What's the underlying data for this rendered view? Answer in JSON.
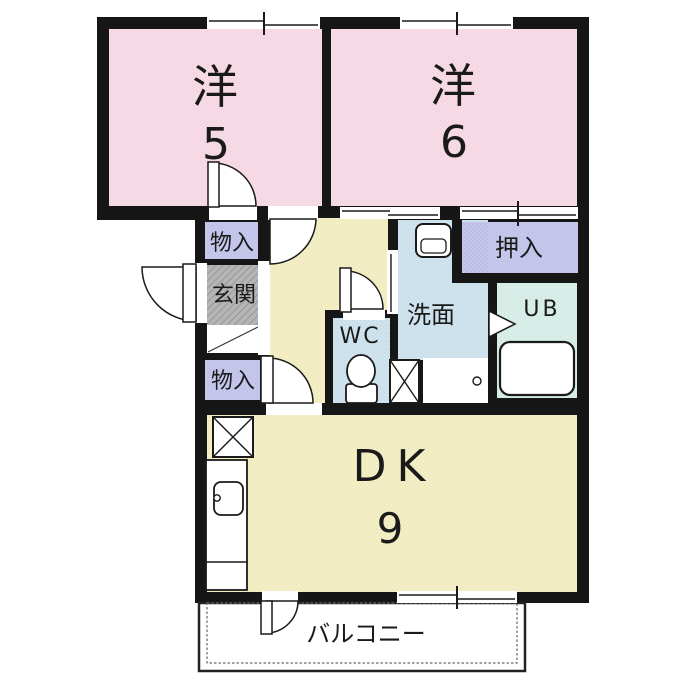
{
  "plan": {
    "type": "floor-plan",
    "layout_name": "2DK"
  },
  "colors": {
    "wall": "#161616",
    "room_pink": "#f8dbe7",
    "hall_cream": "#f5efc5",
    "closet_lavender": "#c6c7ec",
    "entry_gray": "#b5b5b5",
    "wet_blue": "#cfe4ee",
    "bath_mint": "#d9efe9",
    "fixture_white": "#ffffff",
    "balcony_line": "#333333"
  },
  "rooms": {
    "bedroom_west_5": {
      "name": "洋",
      "size": "5"
    },
    "bedroom_west_6": {
      "name": "洋",
      "size": "6"
    },
    "closet_top": {
      "name": "物入"
    },
    "entrance": {
      "name": "玄関"
    },
    "closet_mid": {
      "name": "物入"
    },
    "toilet": {
      "name": "WC"
    },
    "washroom": {
      "name": "洗面"
    },
    "oshiire_closet": {
      "name": "押入"
    },
    "unit_bath": {
      "name": "UB"
    },
    "dining_kitchen": {
      "name": "DK",
      "size": "9"
    },
    "balcony": {
      "name": "バルコニー"
    }
  }
}
